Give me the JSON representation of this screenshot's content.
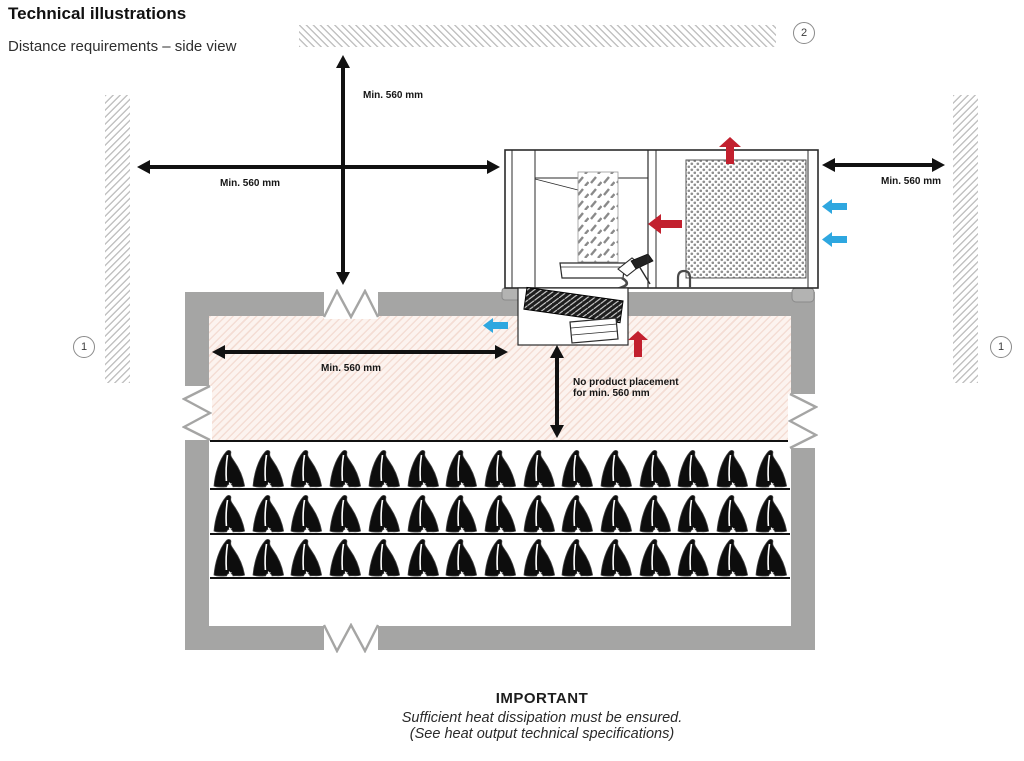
{
  "header": {
    "title": "Technical illustrations",
    "subtitle": "Distance requirements – side view"
  },
  "dimensions": {
    "ceiling_clearance": "Min. 560 mm",
    "left_clearance": "Min. 560 mm",
    "right_clearance": "Min. 560 mm",
    "front_clearance": "Min. 560 mm",
    "no_product_placement_line1": "No product placement",
    "no_product_placement_line2": "for min. 560 mm"
  },
  "callouts": {
    "left_wall": "1",
    "right_wall": "1",
    "ceiling": "2"
  },
  "colors": {
    "hot_air": "#c2202e",
    "cold_air": "#2ea7e0",
    "wall_gray": "#a5a5a4"
  },
  "room": {
    "shelf_count": 3,
    "products_per_shelf": 15,
    "product_icon": "ham-icon"
  },
  "footer": {
    "title": "IMPORTANT",
    "line1": "Sufficient heat dissipation must be ensured.",
    "line2": "(See heat output technical specifications)"
  }
}
